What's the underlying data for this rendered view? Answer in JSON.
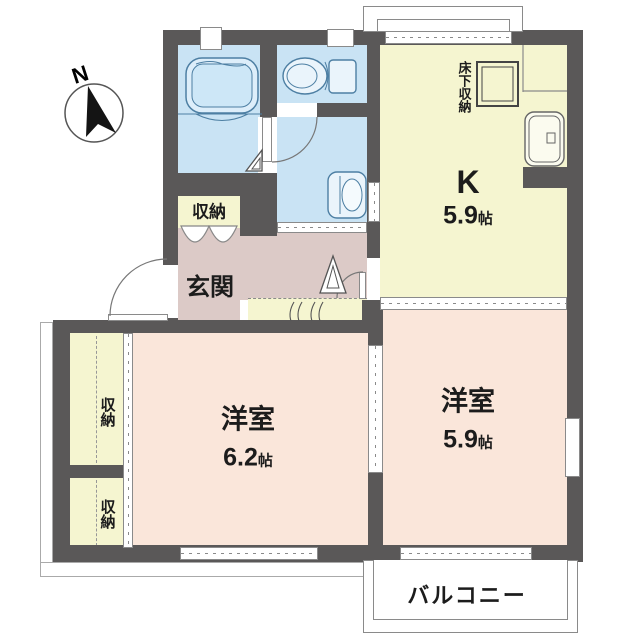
{
  "compass": {
    "north_label": "N"
  },
  "rooms": {
    "kitchen": {
      "label": "K",
      "size_value": "5.9",
      "size_unit": "帖"
    },
    "bedroom_west": {
      "label": "洋室",
      "size_value": "6.2",
      "size_unit": "帖"
    },
    "bedroom_east": {
      "label": "洋室",
      "size_value": "5.9",
      "size_unit": "帖"
    },
    "entrance": {
      "label": "玄関"
    },
    "balcony": {
      "label": "バルコニー"
    },
    "closet_hall": {
      "label": "収納"
    },
    "closet_west_upper": {
      "label": "収納"
    },
    "closet_west_lower": {
      "label": "収納"
    },
    "underfloor_storage": {
      "label": "床下収納"
    }
  },
  "colors": {
    "wall": "#5a5858",
    "wet_area_floor": "#c9e3f4",
    "kitchen_floor": "#f5f5d0",
    "bedroom_floor": "#fae6da",
    "entrance_floor": "#dccac7",
    "fixture_stroke": "#4d7fa3"
  }
}
